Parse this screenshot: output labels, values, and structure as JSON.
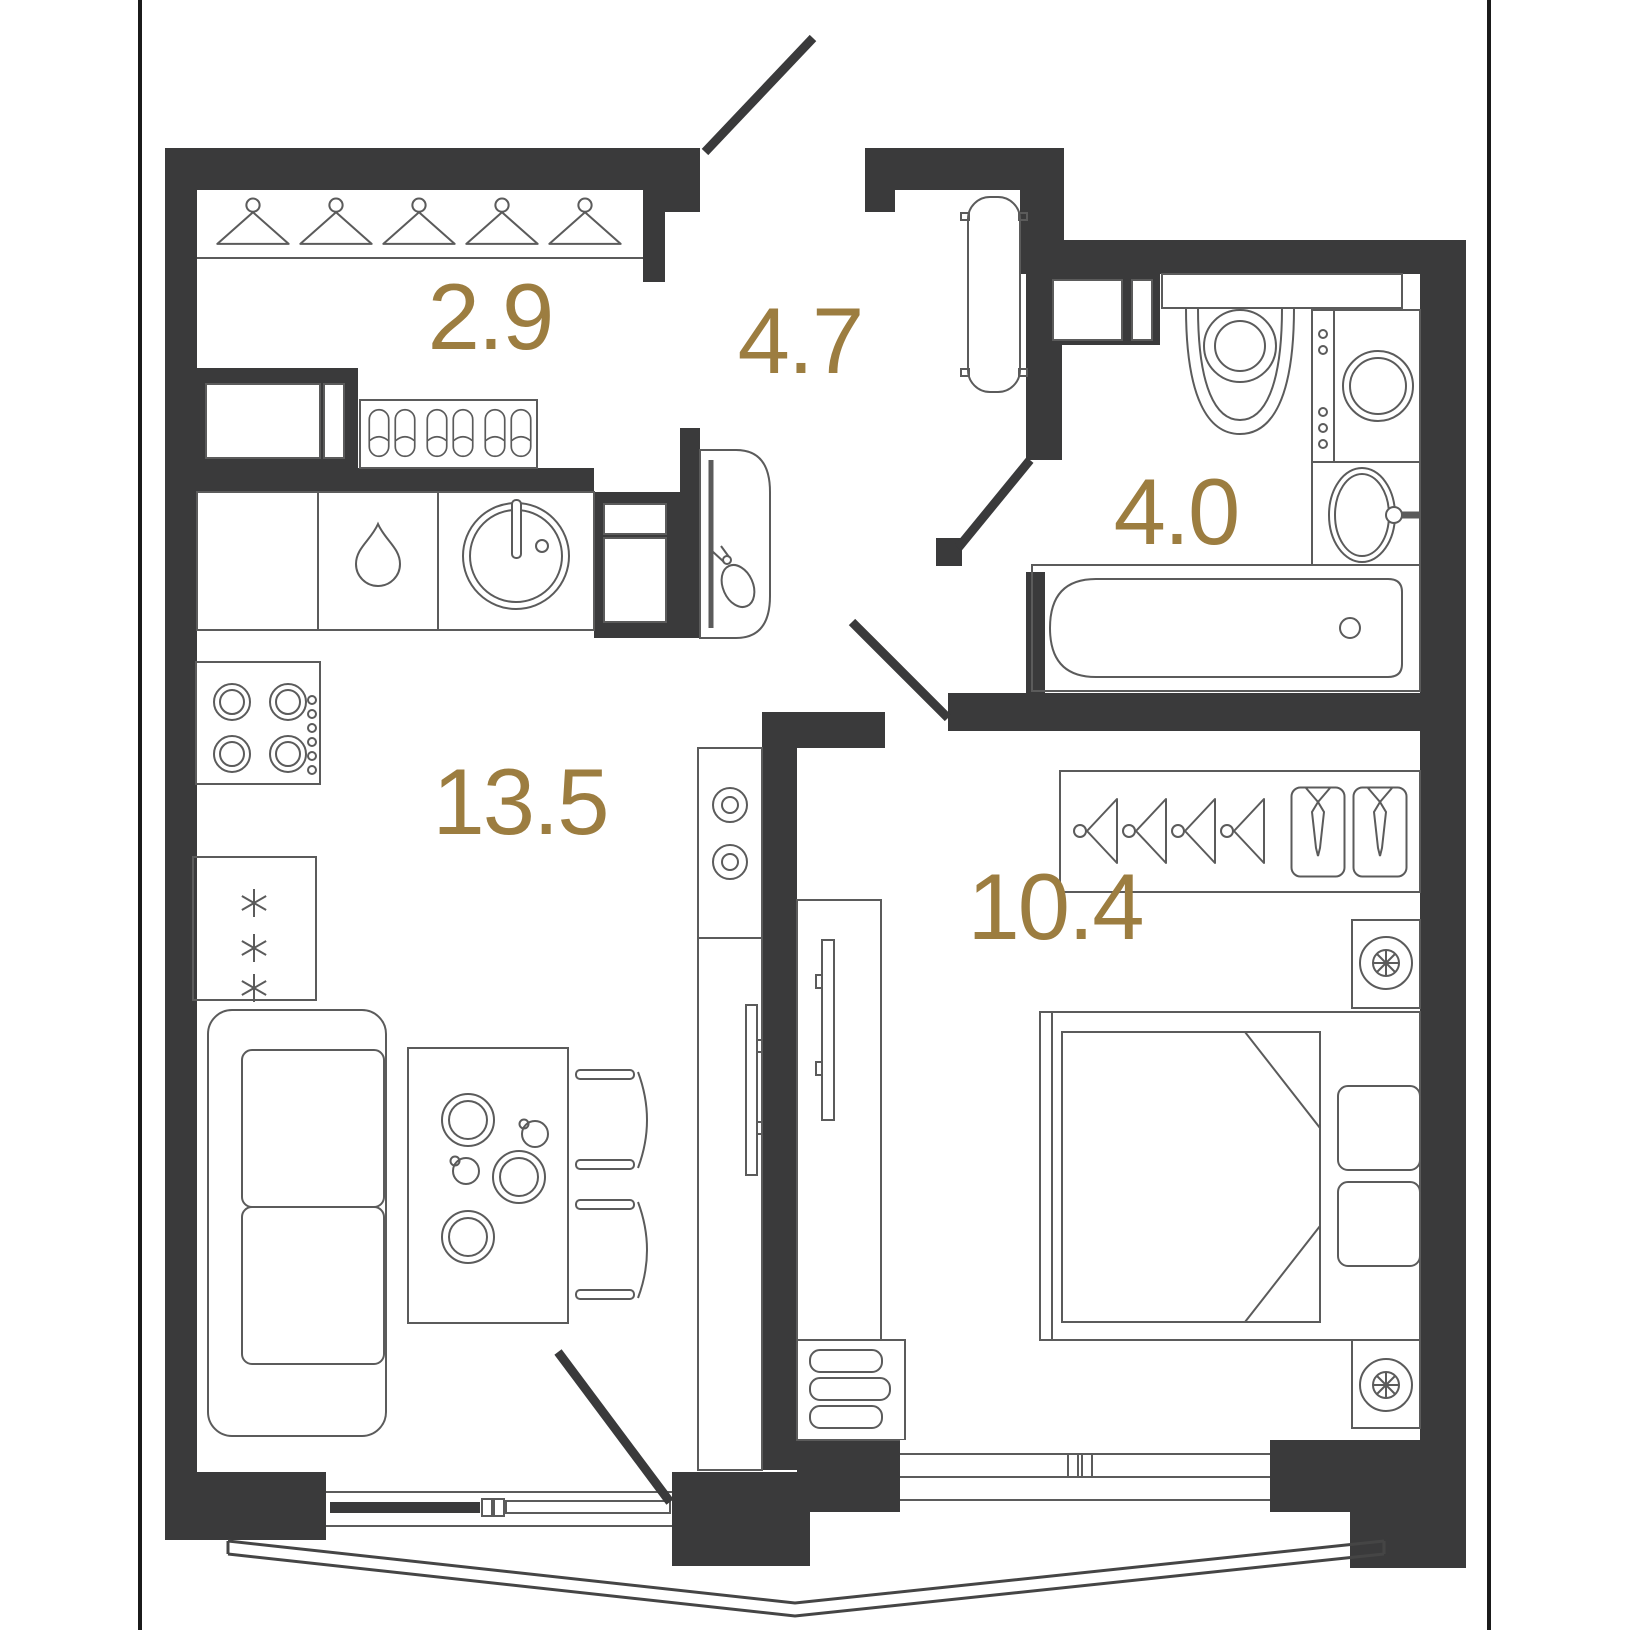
{
  "title": "Apartment floor plan (1-room flat)",
  "colors": {
    "bg": "#ffffff",
    "wall": "#3a3a3b",
    "line": "#5b5b5b",
    "accent": "#9c7d40",
    "frame": "#1b1b1b"
  },
  "rooms": [
    {
      "name": "wardrobe-room",
      "area": "2.9",
      "furniture": [
        "coat-hanger-icon x5",
        "hanger-rail",
        "built-in-cabinet",
        "shoe-shelf with 3 pairs of slippers"
      ]
    },
    {
      "name": "hallway",
      "area": "4.7",
      "furniture": [
        "entrance-door with swing arc",
        "radiator",
        "console-with-mirror and pouch icon",
        "ventilation-shaft"
      ]
    },
    {
      "name": "bathroom",
      "area": "4.0",
      "furniture": [
        "toilet",
        "shelf",
        "washing-machine",
        "washbasin with faucet",
        "bathtub with drain",
        "door with swing"
      ]
    },
    {
      "name": "kitchen-living-room",
      "area": "13.5",
      "furniture": [
        "kitchen-counter",
        "dishwasher-drop-icon",
        "round-kitchen-sink with faucet",
        "cooktop-4-burners with knobs",
        "fridge with 3 snowflakes",
        "sofa 2-seat",
        "dining-table with 3 plates and 2 cups",
        "chair x2",
        "media-column with 2 speakers",
        "tv-on-wall",
        "balcony-door with swing",
        "bay-window outline"
      ]
    },
    {
      "name": "bedroom",
      "area": "10.4",
      "furniture": [
        "wardrobe with 4 side hangers and 2 shirts with ties",
        "nightstand-lamp-icon x2",
        "double-bed with blanket fold and 2 pillows",
        "tv-on-wall",
        "drawer-dresser 3 drawers",
        "window"
      ]
    }
  ]
}
